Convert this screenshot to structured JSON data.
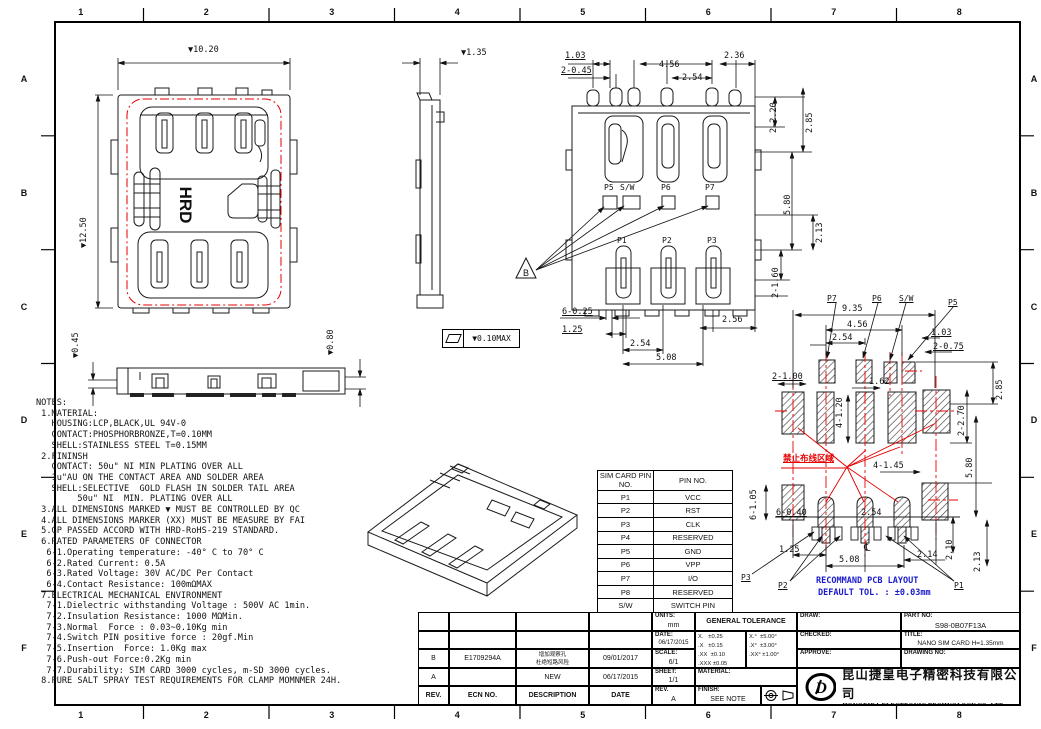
{
  "sheet": {
    "red": "#e60000",
    "blue": "#1a1acc"
  },
  "border": {
    "cols": [
      "1",
      "2",
      "3",
      "4",
      "5",
      "6",
      "7",
      "8"
    ],
    "rows": [
      "A",
      "B",
      "C",
      "D",
      "E",
      "F"
    ]
  },
  "notes": {
    "lines": [
      "NOTES:",
      " 1.MATERIAL:",
      "   HOUSING:LCP,BLACK,UL 94V-0",
      "   CONTACT:PHOSPHORBRONZE,T=0.10MM",
      "   SHELL:STAINLESS STEEL T=0.15MM",
      " 2.FININSH",
      "   CONTACT: 50u\" NI MIN PLATING OVER ALL",
      "   1u\"AU ON THE CONTACT AREA AND SOLDER AREA",
      "   SHELL:SELECTIVE  GOLD FLASH IN SOLDER TAIL AREA",
      "        50u\" NI  MIN. PLATING OVER ALL",
      " 3.ALL DIMENSIONS MARKED ▼ MUST BE CONTROLLED BY QC",
      " 4.ALL DIMENSIONS MARKER (XX) MUST BE MEASURE BY FAI",
      " 5.GP PASSED ACCORD WITH HRD-RoHS-219 STANDARD.",
      " 6.RATED PARAMETERS OF CONNECTOR",
      "  6-1.Operating temperature: -40° C to 70° C",
      "  6-2.Rated Current: 0.5A",
      "  6-3.Rated Voltage: 30V AC/DC Per Contact",
      "  6-4.Contact Resistance: 100mΩMAX",
      " 7.ELECTRICAL MECHANICAL ENVIRONMENT",
      "  7-1.Dielectric withstanding Voltage : 500V AC 1min.",
      "  7-2.Insulation Resistance: 1000 MΩMin.",
      "  7-3.Normal  Force : 0.03~0.10Kg min",
      "  7-4.Switch PIN positive force : 20gf.Min",
      "  7-5.Insertion  Force: 1.0Kg max",
      "  7-6.Push-out Force:0.2Kg min",
      "  7-7.Durability: SIM CARD 3000 cycles, m-SD 3000 cycles.",
      " 8.PURE SALT SPRAY TEST REQUIREMENTS FOR CLAMP MOMNMER 24H."
    ]
  },
  "views": {
    "top_view": {
      "width": "▼10.20",
      "height": "▼12.50",
      "marking": "HRD"
    },
    "side_view": {
      "height": "▼1.35"
    },
    "front_view": {
      "left": "▼0.45",
      "right": "▼0.80"
    },
    "flatness": "▼0.10MAX",
    "bottom_view": {
      "datum_flag": "B",
      "top_dims": [
        "1.03",
        "2-0.45",
        "4.56",
        "2.54",
        "2.36"
      ],
      "right_dims": [
        "2-2.20",
        "2.85",
        "5.80",
        "2.13",
        "2-1.60"
      ],
      "bottom_dims": [
        "6-0.25",
        "1.25",
        "2.54",
        "5.08",
        "2.56"
      ],
      "upper_pins": [
        "P5",
        "S/W",
        "P6",
        "P7"
      ],
      "lower_pins": [
        "P1",
        "P2",
        "P3"
      ]
    },
    "pcb": {
      "pins_top": [
        "P7",
        "P6",
        "S/W",
        "P5"
      ],
      "pins_bottom": [
        "P3",
        "P2",
        "P1"
      ],
      "dims": {
        "w1": "9.35",
        "w2": "4.56",
        "w3": "2.54",
        "w4": "1.03",
        "w5": "2-0.75",
        "w6": "2-1.00",
        "w7": "1.62",
        "w8": "4-1.45",
        "w9": "6-0.40",
        "w10": "2.54",
        "w11": "1.25",
        "w12": "5.08",
        "w13": "2.14",
        "v1": "4-1.20",
        "v2": "2.85",
        "v3": "2-2.70",
        "v4": "5.80",
        "v5": "6-1.05",
        "v6": "2.10",
        "v7": "2.13"
      },
      "centerline_symbol": "℄",
      "keepout_text": "禁止布线区域",
      "note_line1": "RECOMMAND PCB LAYOUT",
      "note_line2": "DEFAULT TOL. : ±0.03mm"
    }
  },
  "pin_table": {
    "headers": [
      "SIM CARD PIN NO.",
      "PIN NO."
    ],
    "rows": [
      [
        "P1",
        "VCC"
      ],
      [
        "P2",
        "RST"
      ],
      [
        "P3",
        "CLK"
      ],
      [
        "P4",
        "RESERVED"
      ],
      [
        "P5",
        "GND"
      ],
      [
        "P6",
        "VPP"
      ],
      [
        "P7",
        "I/O"
      ],
      [
        "P8",
        "RESERVED"
      ],
      [
        "S/W",
        "SWITCH PIN"
      ]
    ]
  },
  "rev_table": {
    "headers": [
      "REV.",
      "ECN NO.",
      "DESCRIPTION",
      "DATE"
    ],
    "rows": [
      {
        "rev": "B",
        "ecn": "E1709294A",
        "desc1": "增加观察孔",
        "desc2": "杜绝短路风险",
        "date": "09/01/2017"
      },
      {
        "rev": "A",
        "ecn": "",
        "desc1": "NEW",
        "desc2": "",
        "date": "06/17/2015"
      }
    ]
  },
  "title_block": {
    "units_label": "UNITS:",
    "units": "mm",
    "date_label": "DATE:",
    "date": "06/17/2015",
    "scale_label": "SCALE:",
    "scale": "6/1",
    "sheet_label": "SHEET:",
    "sheet": "1/1",
    "rev_label": "REV.",
    "rev": "A",
    "tol_header": "GENERAL TOLERANCE",
    "tol_left": "X.   ±0.25\n.X   ±0.15\n.XX  ±0.10\n.XXX ±0.05",
    "tol_right": "X.°  ±5.00°\n.X°  ±3.00°\n.XX° ±1.00°",
    "material_label": "MATERIAL:",
    "finish_label": "FINISH:",
    "finish": "SEE NOTE",
    "draw_label": "DRAW:",
    "checked_label": "CHECKED:",
    "approve_label": "APPROVE:",
    "part_no_label": "PART NO:",
    "part_no": "S98-0B07F13A",
    "title_label": "TITLE:",
    "title": "NANO SIM CARD  H=1.35mm",
    "drawing_no_label": "DRAWING NO:",
    "company_cn": "昆山捷皇电子精密科技有限公司",
    "company_en": "HONGRIDA ELECTRONIC TECHNOLOGY CO.,LTD."
  }
}
